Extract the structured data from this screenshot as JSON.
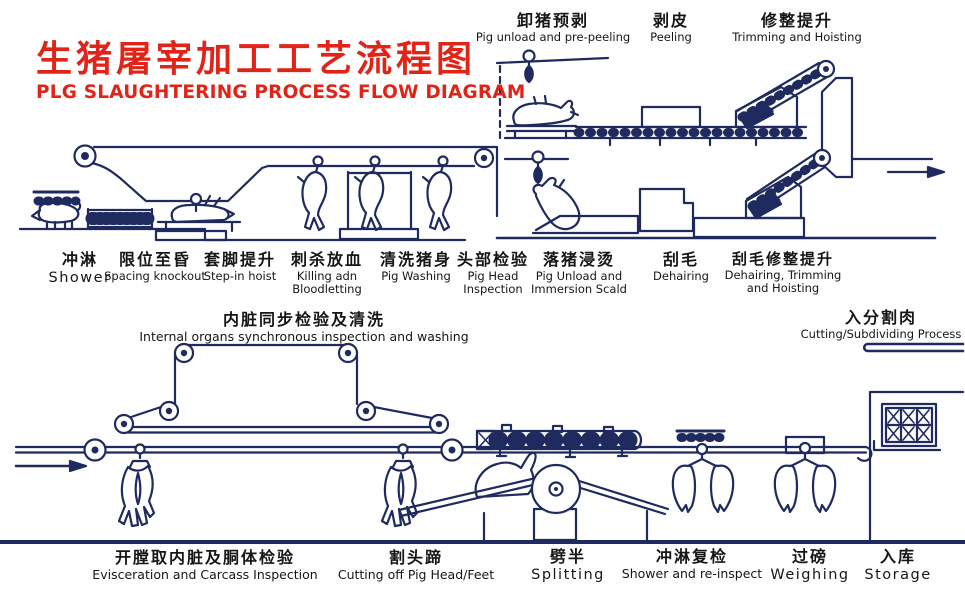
{
  "title": {
    "zh": "生猪屠宰加工工艺流程图",
    "en": "PLG SLAUGHTERING PROCESS FLOW DIAGRAM"
  },
  "stations": {
    "top": [
      {
        "zh": "卸猪预剥",
        "en": "Pig unload and pre-peeling"
      },
      {
        "zh": "剥皮",
        "en": "Peeling"
      },
      {
        "zh": "修整提升",
        "en": "Trimming and Hoisting"
      }
    ],
    "line1": [
      {
        "zh": "冲淋",
        "en": "Shower"
      },
      {
        "zh": "限位至昏",
        "en": "Spacing knockout"
      },
      {
        "zh": "套脚提升",
        "en": "Step-in hoist"
      },
      {
        "zh": "刺杀放血",
        "en": "Killing adn Bloodletting"
      },
      {
        "zh": "清洗猪身",
        "en": "Pig Washing"
      },
      {
        "zh": "头部检验",
        "en": "Pig Head Inspection"
      },
      {
        "zh": "落猪浸烫",
        "en": "Pig Unload and Immersion Scald"
      },
      {
        "zh": "刮毛",
        "en": "Dehairing"
      },
      {
        "zh": "刮毛修整提升",
        "en": "Dehairing, Trimming and Hoisting"
      }
    ],
    "mid": [
      {
        "zh": "内脏同步检验及清洗",
        "en": "Internal organs synchronous inspection and washing"
      },
      {
        "zh": "入分割肉",
        "en": "Cutting/Subdividing Process"
      }
    ],
    "line2": [
      {
        "zh": "开膛取内脏及胴体检验",
        "en": "Evisceration and Carcass Inspection"
      },
      {
        "zh": "割头蹄",
        "en": "Cutting off Pig Head/Feet"
      },
      {
        "zh": "劈半",
        "en": "Splitting"
      },
      {
        "zh": "冲淋复检",
        "en": "Shower and re-inspect"
      },
      {
        "zh": "过磅",
        "en": "Weighing"
      },
      {
        "zh": "入库",
        "en": "Storage"
      }
    ]
  },
  "colors": {
    "line": "#1f2b5e",
    "title_red": "#e02418",
    "text": "#161616",
    "background": "#ffffff"
  }
}
